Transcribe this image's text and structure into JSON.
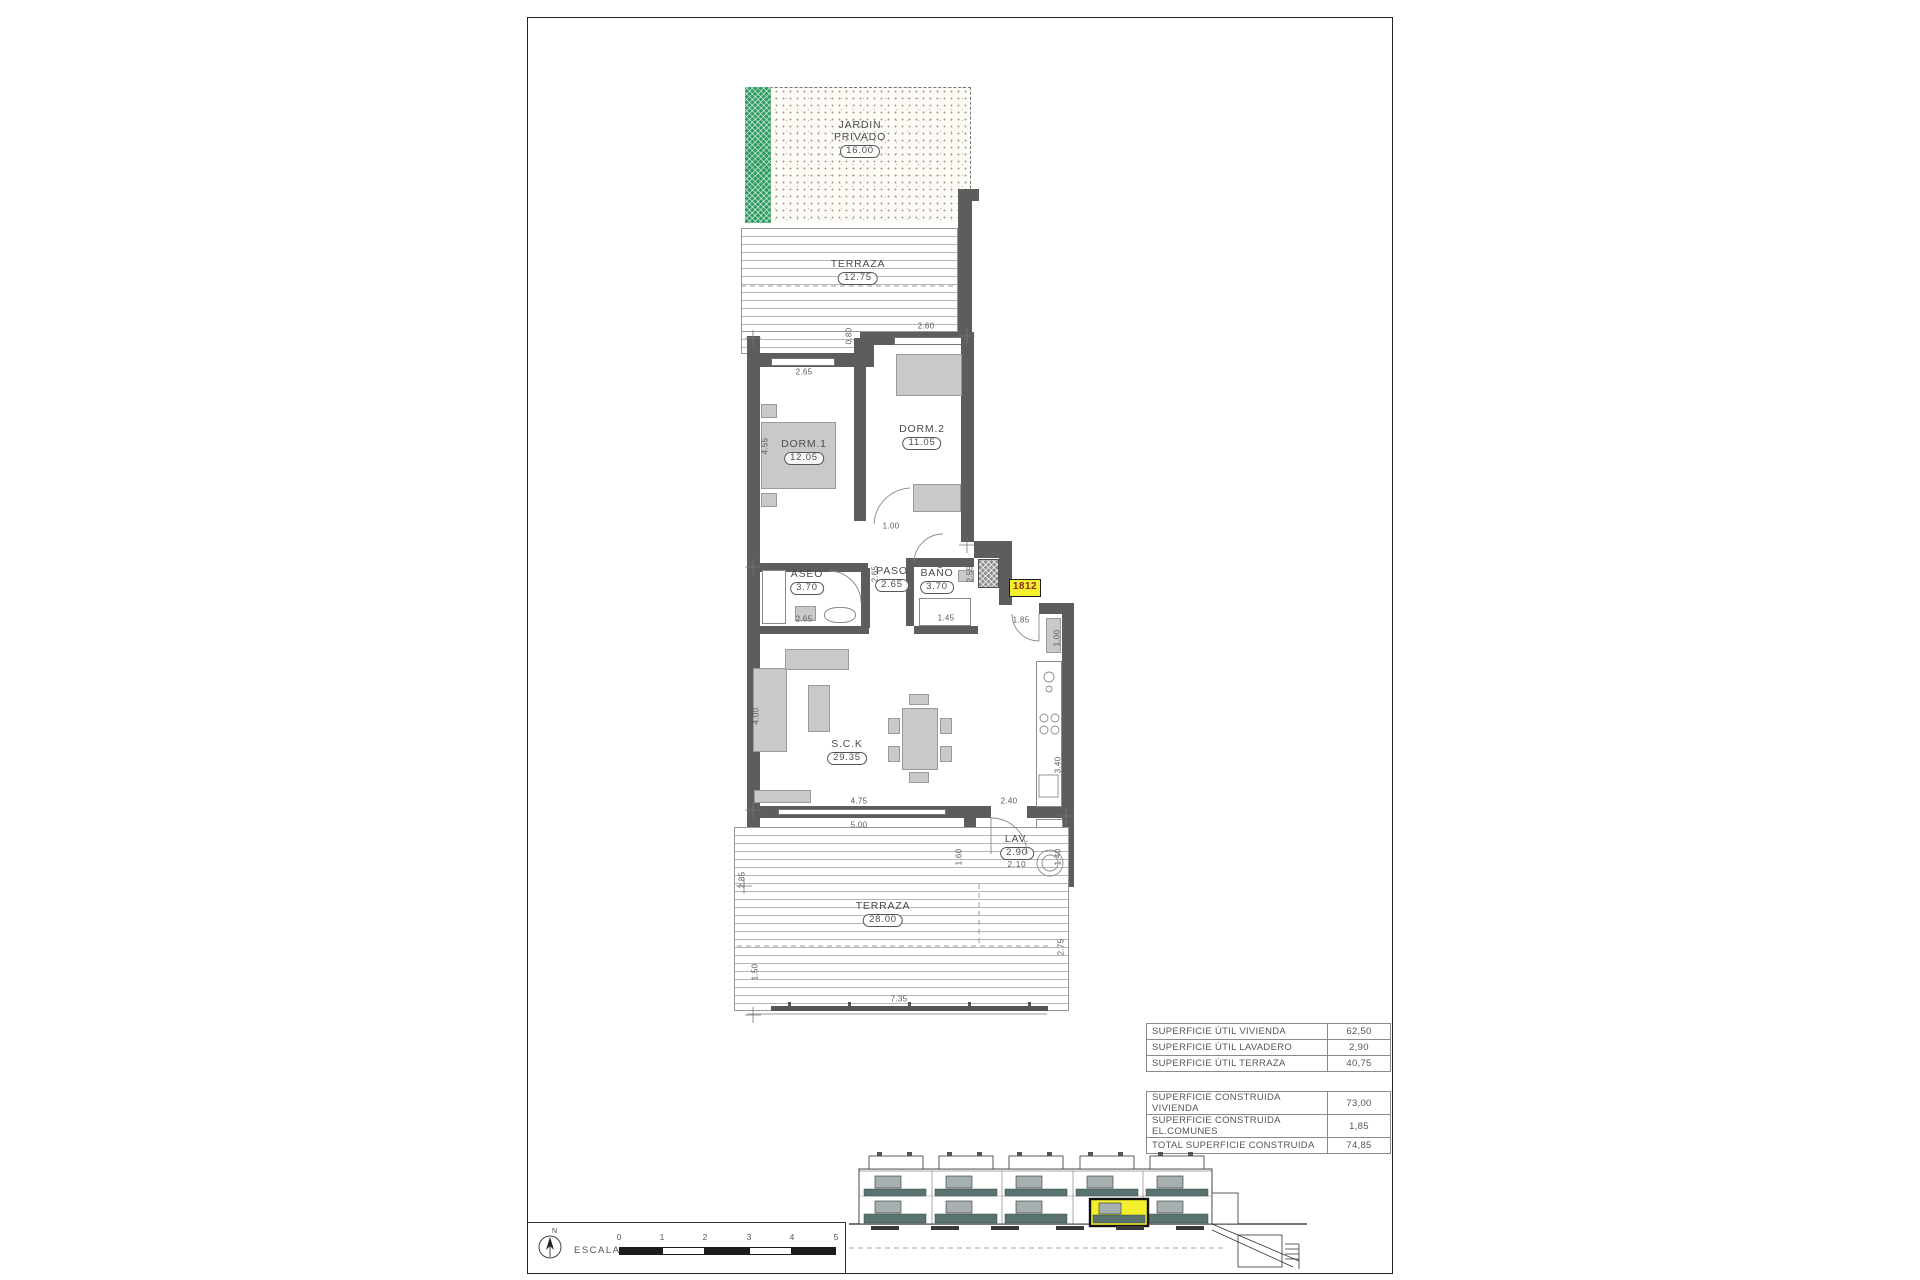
{
  "plan": {
    "garden": {
      "label_line1": "JARDIN",
      "label_line2": "PRIVADO",
      "area": "16.00"
    },
    "rooms": {
      "terraza_top": {
        "name": "TERRAZA",
        "area": "12.75"
      },
      "dorm1": {
        "name": "DORM.1",
        "area": "12.05"
      },
      "dorm2": {
        "name": "DORM.2",
        "area": "11.05"
      },
      "aseo": {
        "name": "ASEO",
        "area": "3.70"
      },
      "paso": {
        "name": "PASO",
        "area": "2.65"
      },
      "bano": {
        "name": "BAÑO",
        "area": "3.70"
      },
      "salon_cocina": {
        "name": "S.C.K",
        "area": "29.35"
      },
      "lavadero": {
        "name": "LAV.",
        "area": "2.90",
        "width_dim": "2.10"
      },
      "terraza_bottom": {
        "name": "TERRAZA",
        "area": "28.00"
      }
    },
    "unit_tag": "1812",
    "dims": {
      "d01": "2.65",
      "d02": "2.60",
      "d03": "0.80",
      "d04": "4.55",
      "d05": "4.25",
      "d06": "1.00",
      "d07": "1.40",
      "d08": "2.65",
      "d09": "2.65",
      "d10": "2.55",
      "d11": "1.45",
      "d12": "1.85",
      "d13": "1.00",
      "d14": "4.00",
      "d15": "4.75",
      "d16": "5.00",
      "d17": "2.40",
      "d18": "3.40",
      "d19": "1.60",
      "d20": "1.40",
      "d21": "2.85",
      "d22": "1.50",
      "d23": "2.75",
      "d24": "7.35",
      "d25": "2.20"
    }
  },
  "tables": {
    "superficies_utiles": {
      "rows": [
        {
          "label": "SUPERFICIE ÚTIL VIVIENDA",
          "value": "62,50"
        },
        {
          "label": "SUPERFICIE ÚTIL LAVADERO",
          "value": "2,90"
        },
        {
          "label": "SUPERFICIE ÚTIL TERRAZA",
          "value": "40,75"
        }
      ]
    },
    "superficies_construidas": {
      "rows": [
        {
          "label": "SUPERFICIE CONSTRUIDA VIVIENDA",
          "value": "73,00"
        },
        {
          "label": "SUPERFICIE CONSTRUIDA EL.COMUNES",
          "value": "1,85"
        },
        {
          "label": "TOTAL SUPERFICIE CONSTRUIDA",
          "value": "74,85"
        }
      ]
    }
  },
  "scale_bar": {
    "north_label": "N",
    "label": "ESCALA :",
    "tick_labels": [
      "0",
      "1",
      "2",
      "3",
      "4",
      "5"
    ]
  },
  "colors": {
    "wall_gray": "#5d5d5d",
    "garden_green": "#2e9c60",
    "highlight_yellow": "#f3ef2d",
    "unit_tag_text": "#8a2a1a",
    "balcony_teal": "#5b7370"
  }
}
